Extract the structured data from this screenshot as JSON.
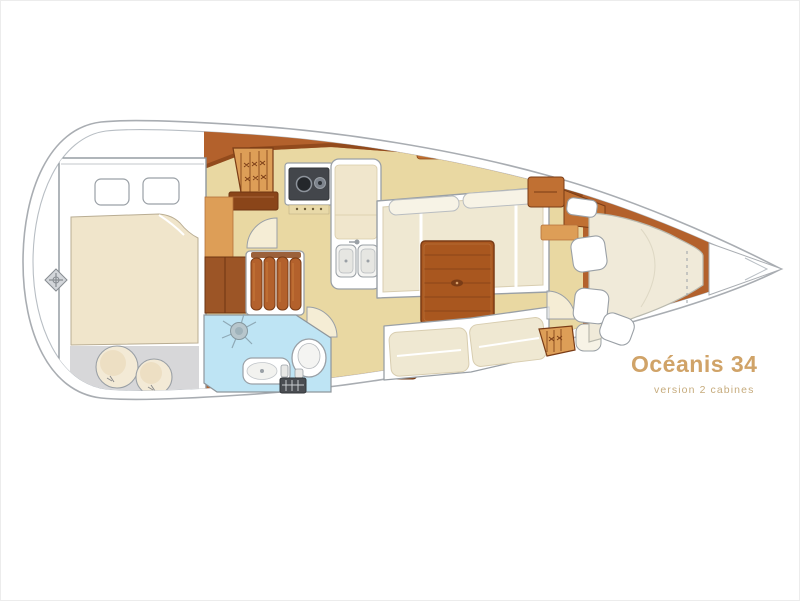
{
  "title": {
    "name": "Océanis 34",
    "version": "version 2 cabines"
  },
  "colors": {
    "hull-outline": "#a9adb2",
    "deck-line": "#b8bec4",
    "wood": "#b3612c",
    "wood-dark": "#8a4519",
    "wood-mid": "#c07033",
    "wood-light": "#dd9e57",
    "floor": "#e9d8a2",
    "cushion": "#efe8d2",
    "bed": "#f0e5cb",
    "head-floor": "#bee4f4",
    "sole-gray": "#d7d7d9",
    "table": "#a9571f",
    "stove": "#43464b",
    "title-color": "#d0a368",
    "subtitle-color": "#c6ab7c"
  },
  "icons": {
    "compass-rose-icon": "gray diamond with cross",
    "shower-drain-icon": "circle with radiating spokes",
    "stove-burners-icon": "two circles on dark cooktop",
    "hanging-locker-icon": "hatched trapezoid with hanger marks",
    "floor-grate-icon": "dark rectangle with grid",
    "door-swing-icon": "quarter-circle arc"
  }
}
